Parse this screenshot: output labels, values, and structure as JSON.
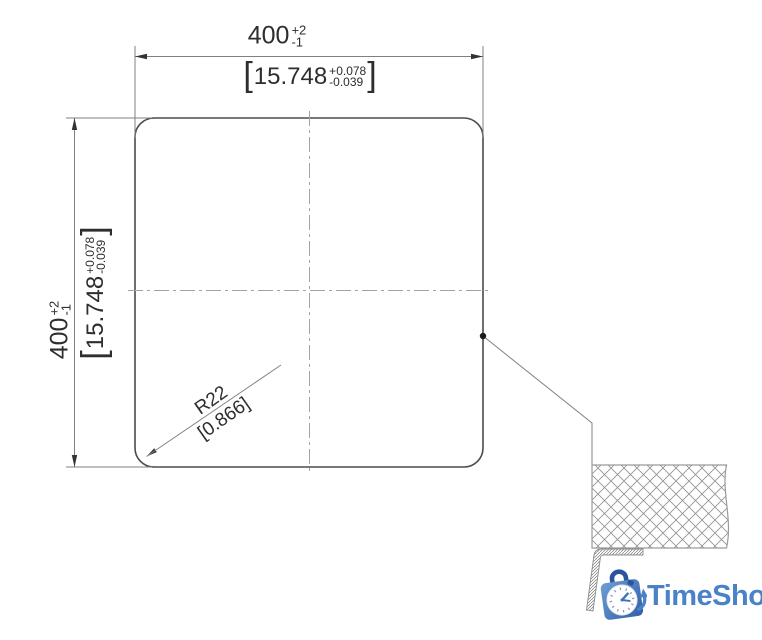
{
  "dimensions": {
    "width": {
      "mm": {
        "value": "400",
        "plus": "+2",
        "minus": "-1"
      },
      "inch": {
        "open": "[",
        "value": "15.748",
        "plus": "+0.078",
        "minus": "-0.039",
        "close": "]"
      }
    },
    "height": {
      "mm": {
        "value": "400",
        "plus": "+2",
        "minus": "-1"
      },
      "inch": {
        "open": "[",
        "value": "15.748",
        "plus": "+0.078",
        "minus": "-0.039",
        "close": "]"
      }
    },
    "corner_radius": {
      "mm": "R22",
      "inch": "[0.866]"
    }
  },
  "logo": {
    "name": "TimeShop",
    "color": "#4a82c8"
  },
  "colors": {
    "outline": "#4b4b4b",
    "dimension": "#808080",
    "centerline": "#a3a3a3",
    "hatch": "#909090",
    "text": "#2e2e2e",
    "logo_blue": "#4a82c8"
  }
}
